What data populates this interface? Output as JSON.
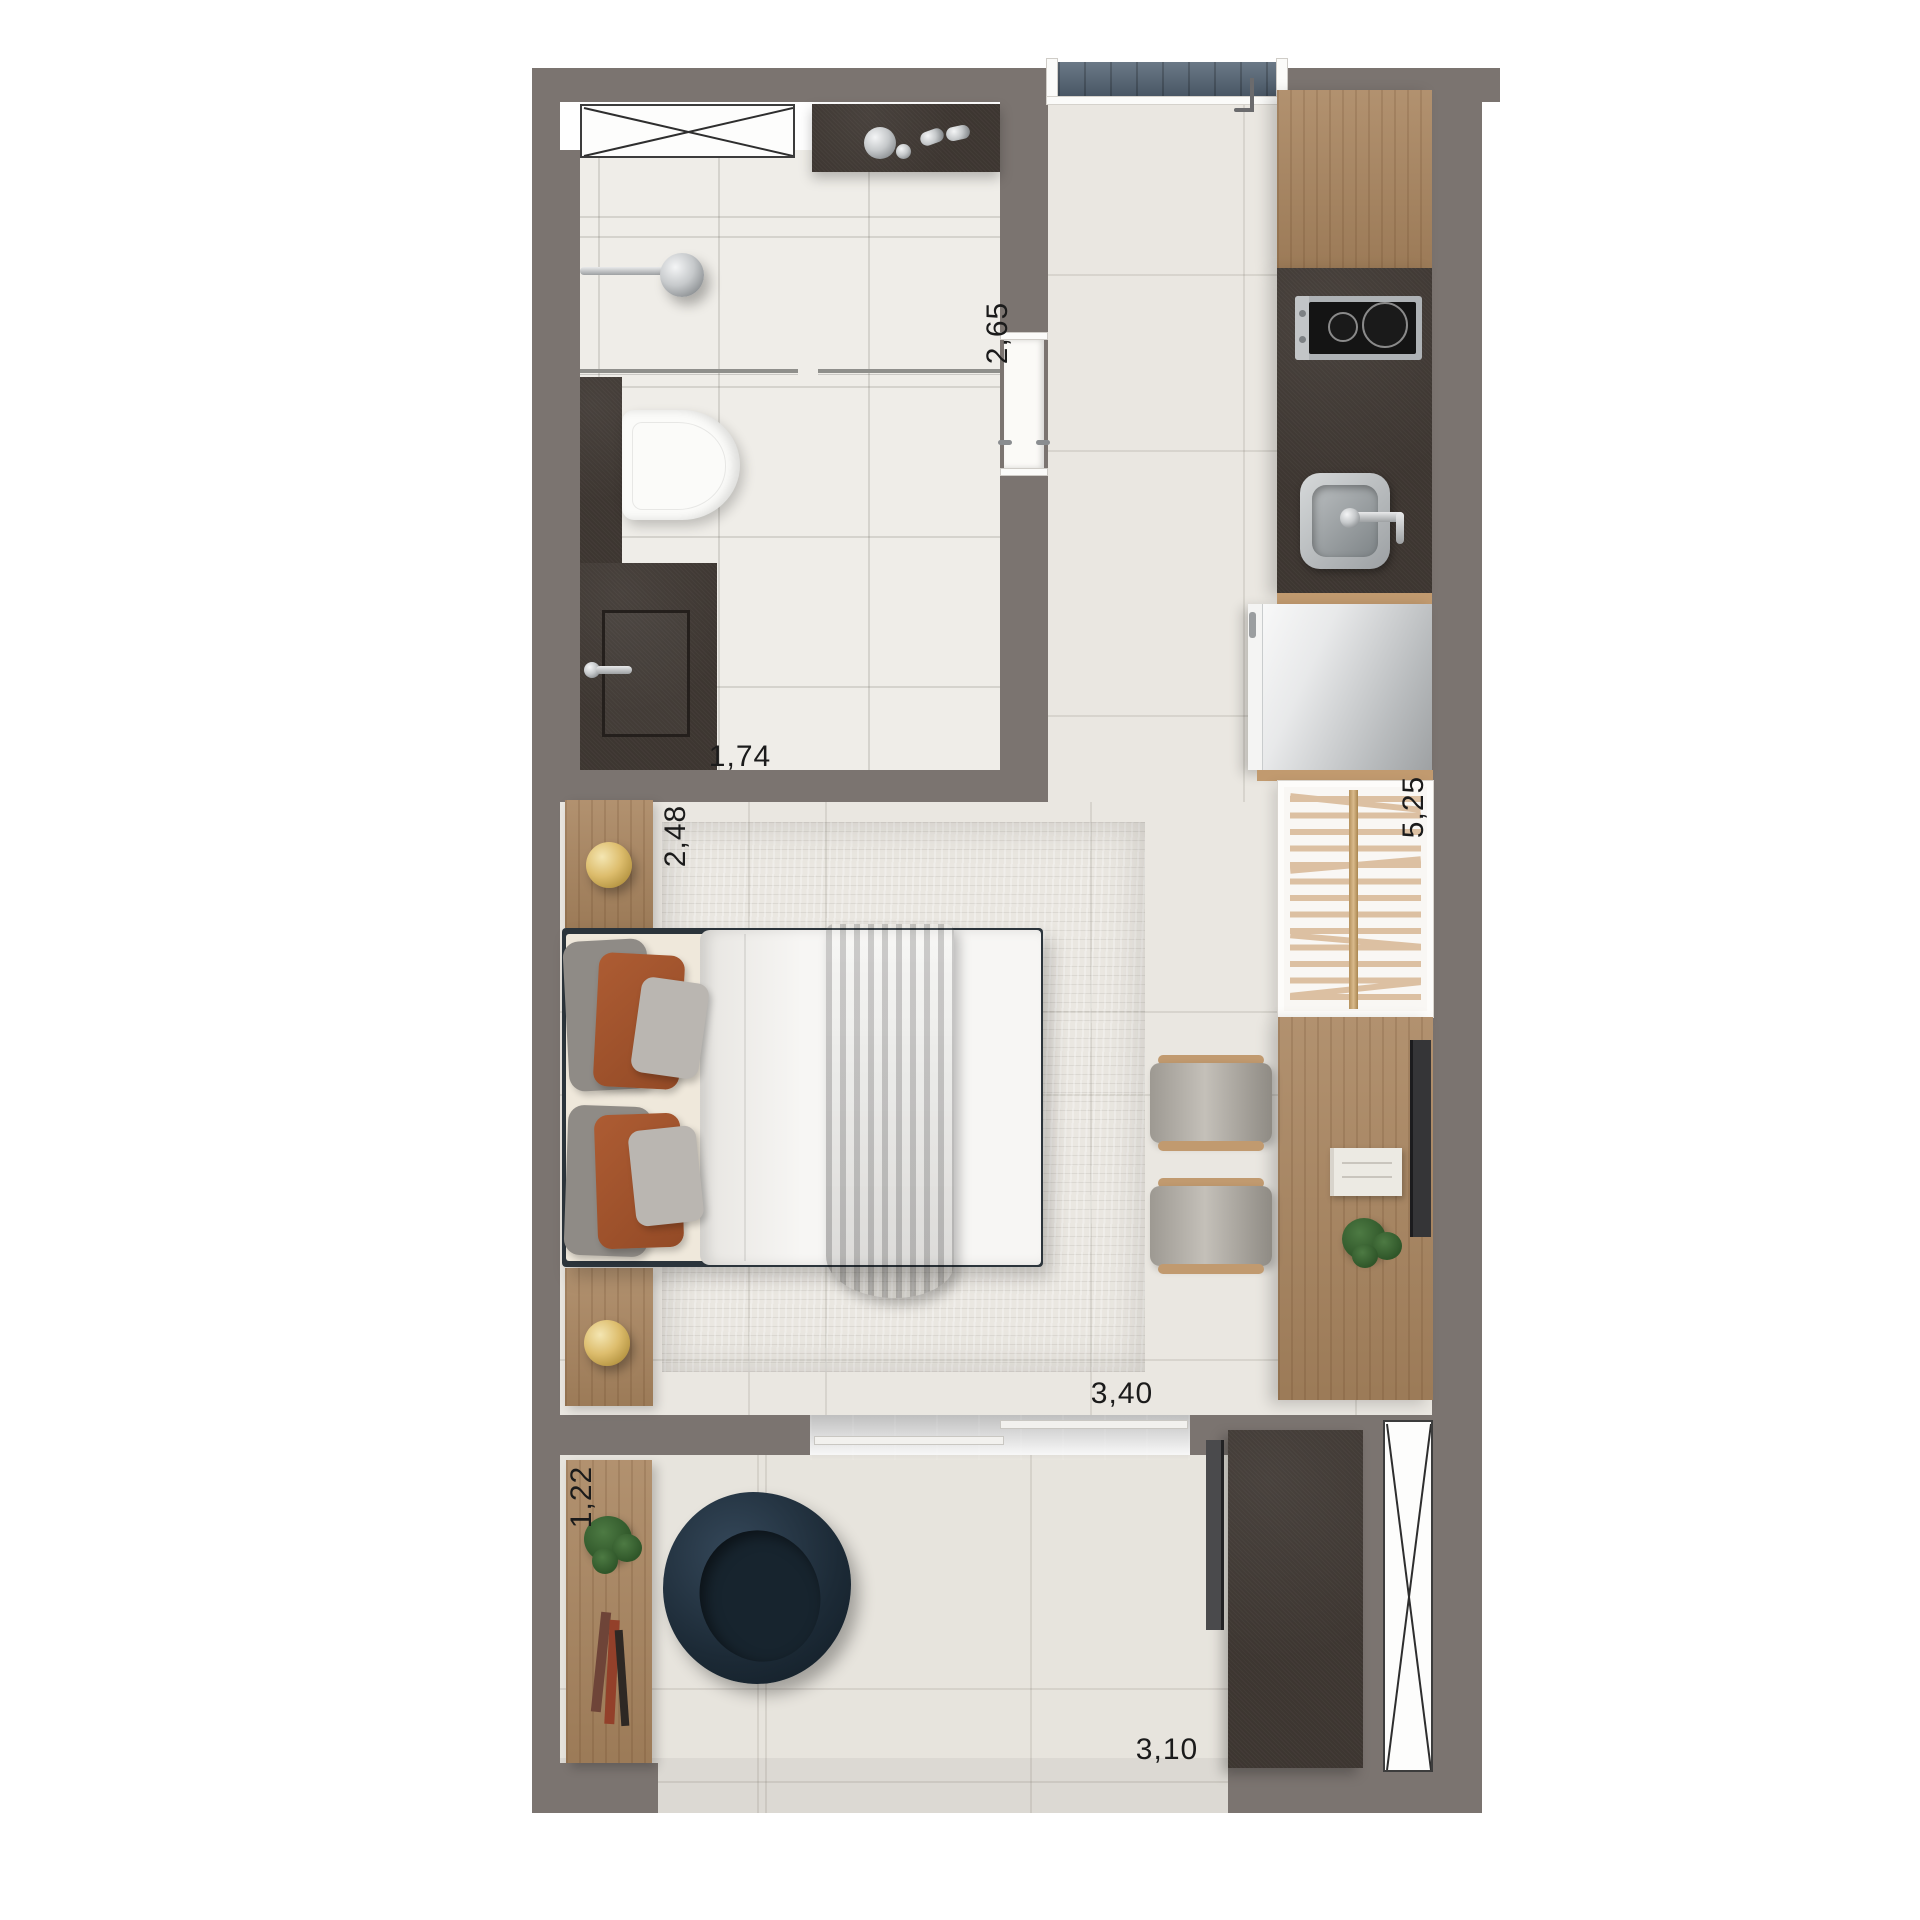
{
  "app": {
    "type": "floor-plan",
    "name": "Studio apartment floor plan"
  },
  "palette": {
    "wall": "#7b7470",
    "bathroom_floor": "#efede8",
    "main_floor": "#eae7e1",
    "terrace_floor": "#e7e4dd",
    "dark_cabinet": "#3d3631",
    "wood": "#a9855f",
    "rug": "#c7c4bf",
    "duvet": "#f6f5f2",
    "accent_rust": "#a9582f",
    "chair_navy": "#1d2b36",
    "glass_blue": "#5d6d7b",
    "gold": "#d9b969",
    "dimension_text": "#1b1b1b"
  },
  "dimension_labels": {
    "bathroom_vertical": "2,65",
    "bathroom_horizontal": "1,74",
    "bedroom_vertical": "2,48",
    "wardrobe_vertical": "5,25",
    "living_horizontal": "3,40",
    "terrace_vertical": "1,22",
    "terrace_horizontal": "3,10"
  },
  "furniture": [
    "window",
    "vanity-counter",
    "shower",
    "glass-partition",
    "toilet",
    "storage-cabinet",
    "entry-mat",
    "kitchen-counter",
    "cooktop",
    "kitchen-sink",
    "fridge",
    "wardrobe",
    "desk",
    "desk-chair",
    "tv",
    "book",
    "plant",
    "double-bed",
    "nightstand",
    "table-lamp",
    "rug",
    "sliding-door",
    "sideboard",
    "lounge-chair",
    "balcony-cabinet",
    "balcony-window"
  ]
}
